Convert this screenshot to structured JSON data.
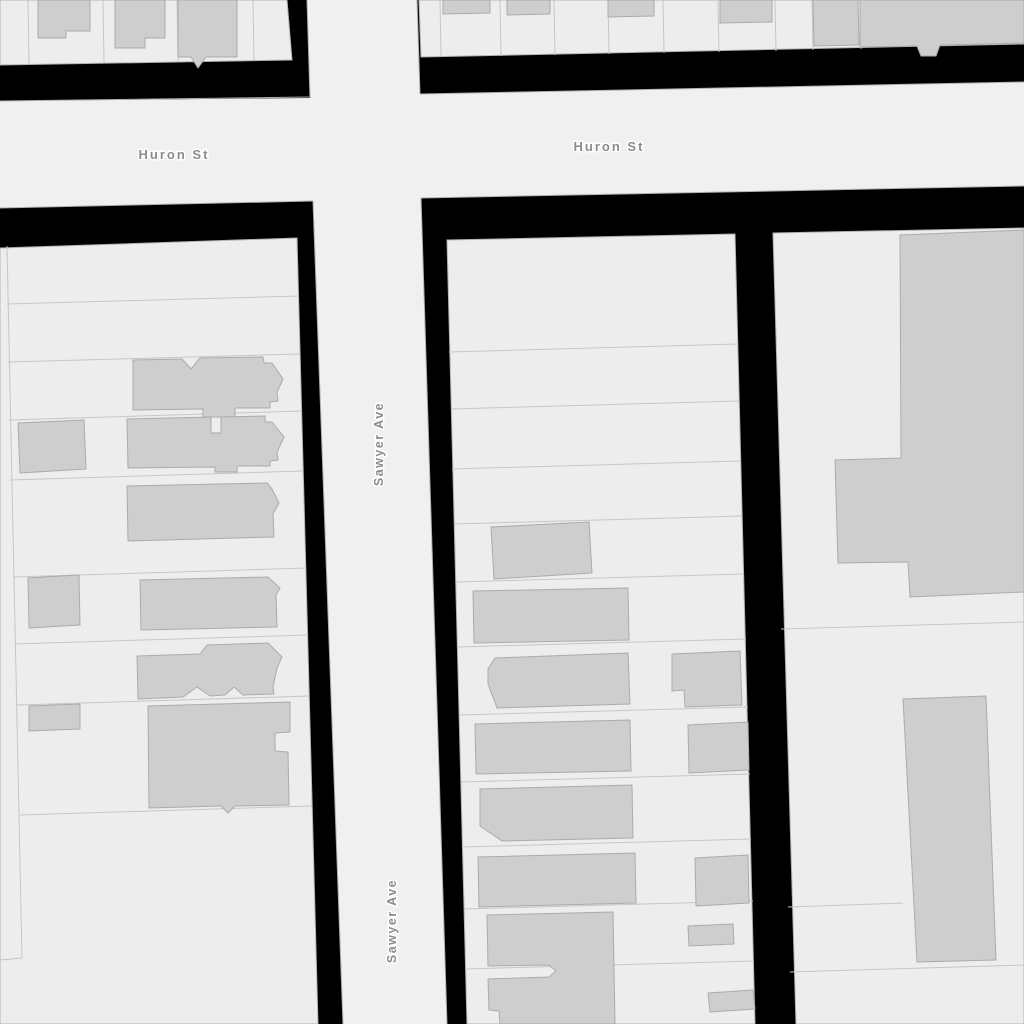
{
  "map": {
    "kind": "grayscale-street-map",
    "streets": [
      {
        "name": "Huron St",
        "orientation": "horizontal"
      },
      {
        "name": "Sawyer Ave",
        "orientation": "vertical"
      }
    ],
    "street_labels": [
      {
        "text": "Huron St"
      },
      {
        "text": "Huron St"
      },
      {
        "text": "Sawyer Ave"
      },
      {
        "text": "Sawyer Ave"
      }
    ]
  },
  "colors": {
    "road": "#f0f0f0",
    "block_margin": "#000000",
    "parcel": "#ededed",
    "parcel_line": "#c6c6c6",
    "block_outline": "#b2b2b2",
    "building": "#cecece",
    "building_outline": "#ababab",
    "road_edge": "#afafaf",
    "street_label": "#8c8c8c",
    "street_label_halo": "#ffffff"
  }
}
